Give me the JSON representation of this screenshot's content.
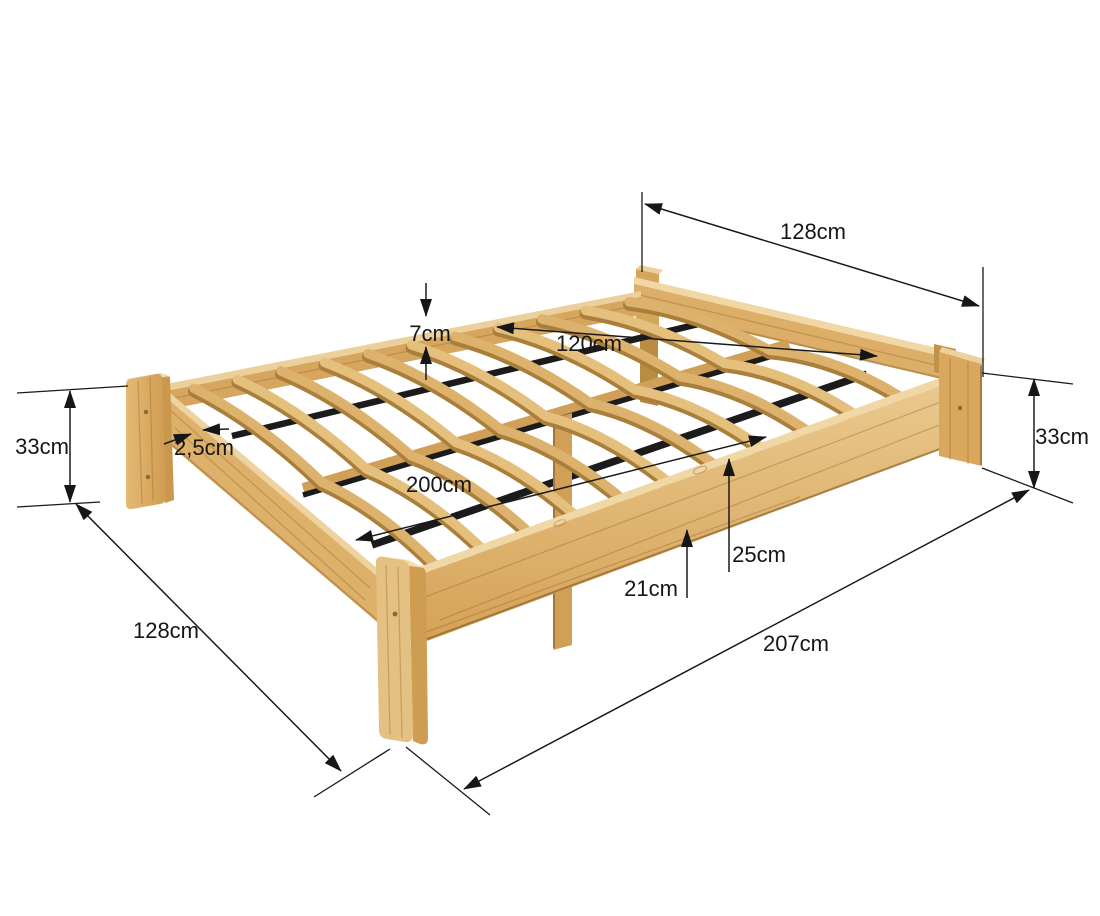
{
  "diagram": {
    "background": "#ffffff",
    "line_color": "#1a1a1a",
    "wood_light": "#f0d7a6",
    "wood_mid": "#e0b671",
    "wood_dark": "#c59349",
    "batten_color": "#1b1b1b",
    "unit": "cm"
  },
  "labels": {
    "head_width": "128cm",
    "rail_height": "7cm",
    "inner_width": "120cm",
    "height_left": "33cm",
    "slat_thickness": "2,5cm",
    "inner_length": "200cm",
    "clearance_low": "21cm",
    "clearance_high": "25cm",
    "height_right": "33cm",
    "outer_length": "207cm",
    "foot_width": "128cm"
  }
}
